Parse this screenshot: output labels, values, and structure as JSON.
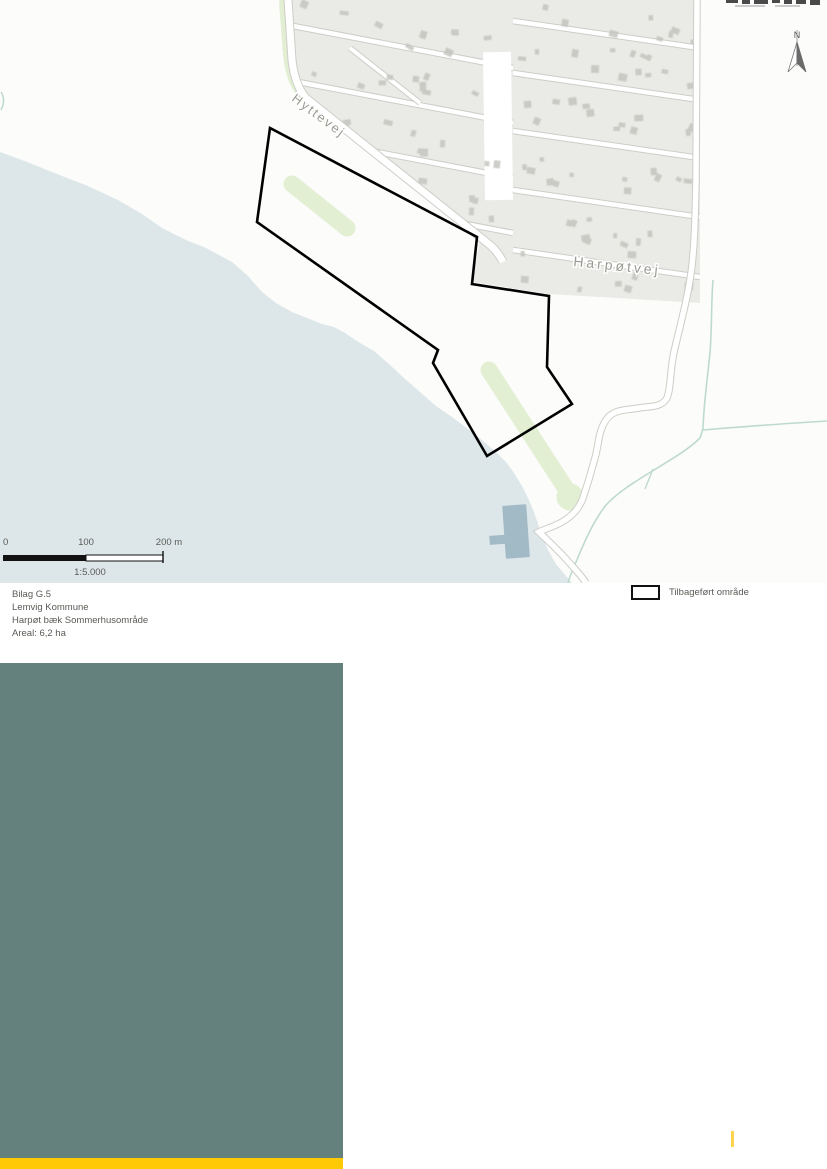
{
  "caption": {
    "line1": "Bilag G.5",
    "line2": "Lemvig Kommune",
    "line3": "Harpøt bæk Sommerhusområde",
    "line4": "Areal: 6,2 ha"
  },
  "legend": {
    "area_label": "Tilbageført område"
  },
  "map": {
    "road_labels": {
      "hyttevej": "Hyttevej",
      "harpotvej": "Harpøtvej"
    },
    "north_label": "N",
    "scalebar": {
      "t0": "0",
      "t100": "100",
      "t200": "200 m",
      "scale_text": "1:5.000"
    }
  },
  "colors": {
    "sea": "#dde7ea",
    "land": "#fcfcfa",
    "parcels": "#eaeae7",
    "building": "#c5c5c0",
    "road_edge": "#cdcdc8",
    "road_fill": "#ffffff",
    "green": "#e2efd3",
    "stream": "#bedacd",
    "pier": "#a2b9c6",
    "boundary": "#000000",
    "map_label": "#9b9b95",
    "text": "#5a5a55",
    "teal_block": "#65817e",
    "yellow_bar": "#ffc905",
    "yellow_tick": "#fdd34d"
  }
}
